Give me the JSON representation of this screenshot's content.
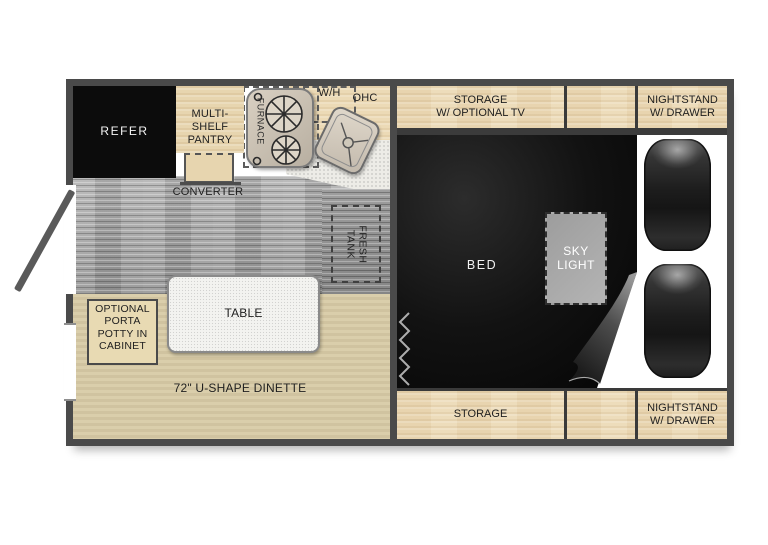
{
  "title": "Truck camper floor plan",
  "colors": {
    "wall": "#4a4a4a",
    "cabinet_wood": "#ecdab6",
    "dinette_tan": "#d8cba6",
    "floor_gray": "#a6a6a6",
    "bed_black": "#0d0d0d",
    "skylight_gray": "#a8a8a8",
    "refer_black": "#0c0c0c"
  },
  "kitchen": {
    "refer": "REFER",
    "pantry": "MULTI-\nSHELF\nPANTRY",
    "converter": "CONVERTER",
    "furnace": "FURNACE",
    "water_heater": "W/H",
    "overhead_cabinet": "OHC",
    "fresh_tank": "FRESH\nTANK",
    "porta_potty": "OPTIONAL\nPORTA\nPOTTY IN\nCABINET",
    "table": "TABLE",
    "dinette": "72\" U-SHAPE DINETTE"
  },
  "bedroom": {
    "storage_tv": "STORAGE\nW/ OPTIONAL TV",
    "nightstand_top": "NIGHTSTAND\nW/ DRAWER",
    "bed": "BED",
    "skylight": "SKY\nLIGHT",
    "storage_bottom": "STORAGE",
    "nightstand_bottom": "NIGHTSTAND\nW/ DRAWER"
  }
}
